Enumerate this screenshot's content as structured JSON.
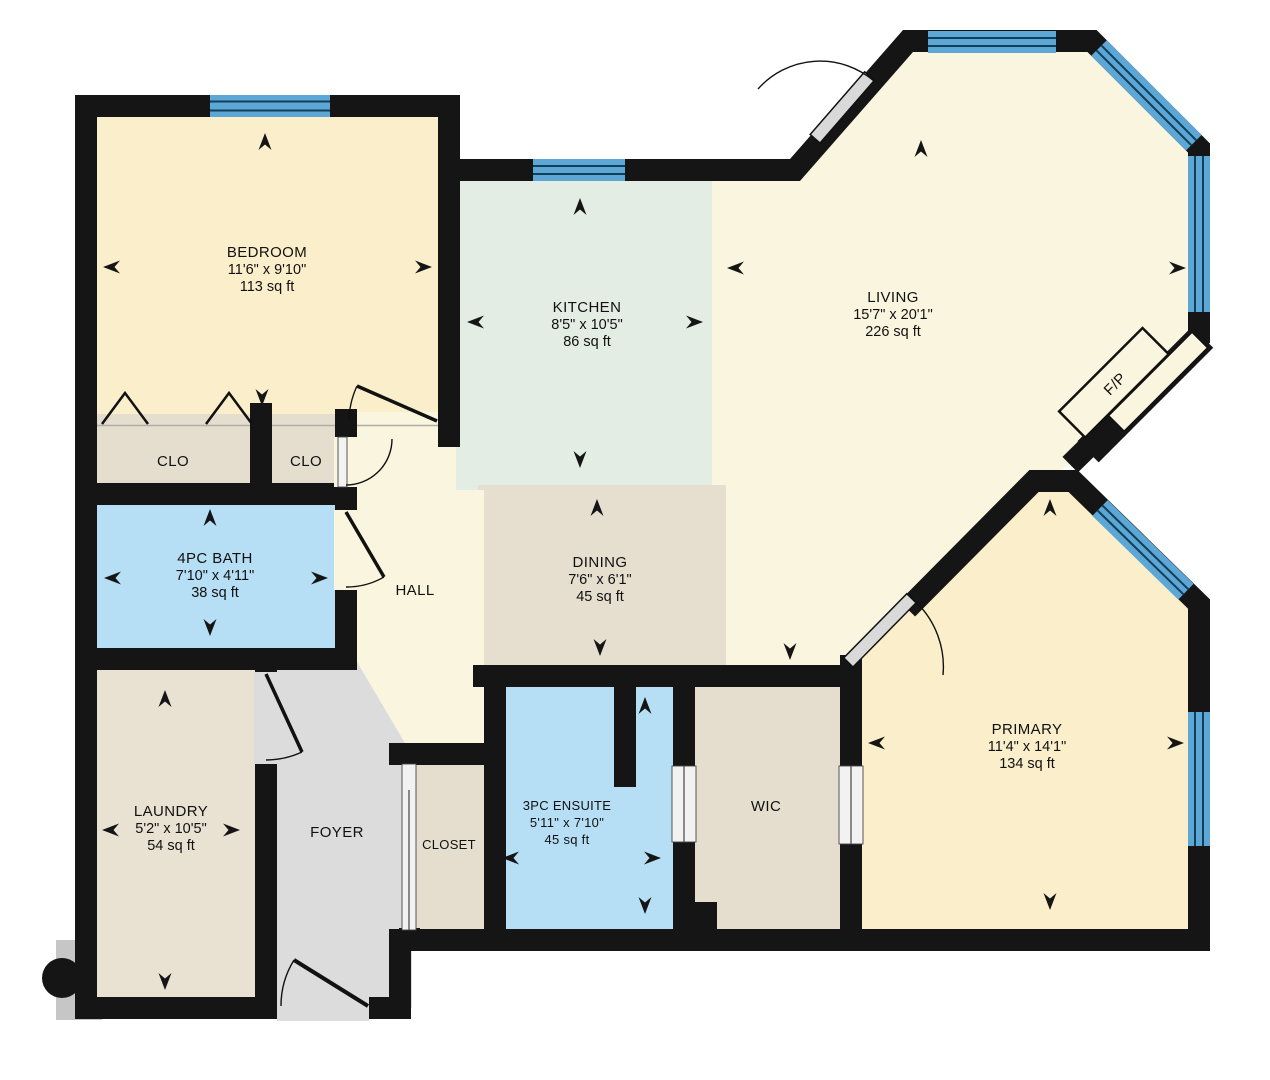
{
  "plan": {
    "background": "#FFFFFF",
    "palette": {
      "wall": "#151515",
      "window_glass": "#5CA7D6",
      "window_mullion": "#123F57",
      "bedroom_fill": "#FAEFCA",
      "primary_fill": "#FAEFCA",
      "living_fill": "#FAF5DE",
      "hall_fill": "#FAF5DE",
      "kitchen_fill": "#E3EDE4",
      "dining_fill": "#E6DFD0",
      "closet_fill": "#E5DECE",
      "laundry_fill": "#E9E1D2",
      "bath_fill": "#B6DEF5",
      "foyer_fill": "#DCDCDC",
      "door_leaf": "#D9D9D9"
    },
    "rooms": {
      "bedroom": {
        "name": "BEDROOM",
        "dims": "11'6\" x 9'10\"",
        "area": "113 sq ft"
      },
      "kitchen": {
        "name": "KITCHEN",
        "dims": "8'5\" x 10'5\"",
        "area": "86 sq ft"
      },
      "living": {
        "name": "LIVING",
        "dims": "15'7\" x 20'1\"",
        "area": "226 sq ft"
      },
      "dining": {
        "name": "DINING",
        "dims": "7'6\" x 6'1\"",
        "area": "45 sq ft"
      },
      "bath": {
        "name": "4PC BATH",
        "dims": "7'10\" x 4'11\"",
        "area": "38 sq ft"
      },
      "laundry": {
        "name": "LAUNDRY",
        "dims": "5'2\" x 10'5\"",
        "area": "54 sq ft"
      },
      "ensuite": {
        "name": "3PC ENSUITE",
        "dims": "5'11\" x 7'10\"",
        "area": "45 sq ft"
      },
      "primary": {
        "name": "PRIMARY",
        "dims": "11'4\" x 14'1\"",
        "area": "134 sq ft"
      },
      "hall": {
        "name": "HALL"
      },
      "foyer": {
        "name": "FOYER"
      },
      "closet": {
        "name": "CLOSET"
      },
      "wic": {
        "name": "WIC"
      },
      "clo_left": {
        "name": "CLO"
      },
      "clo_right": {
        "name": "CLO"
      },
      "fireplace": {
        "name": "F/P"
      }
    }
  }
}
